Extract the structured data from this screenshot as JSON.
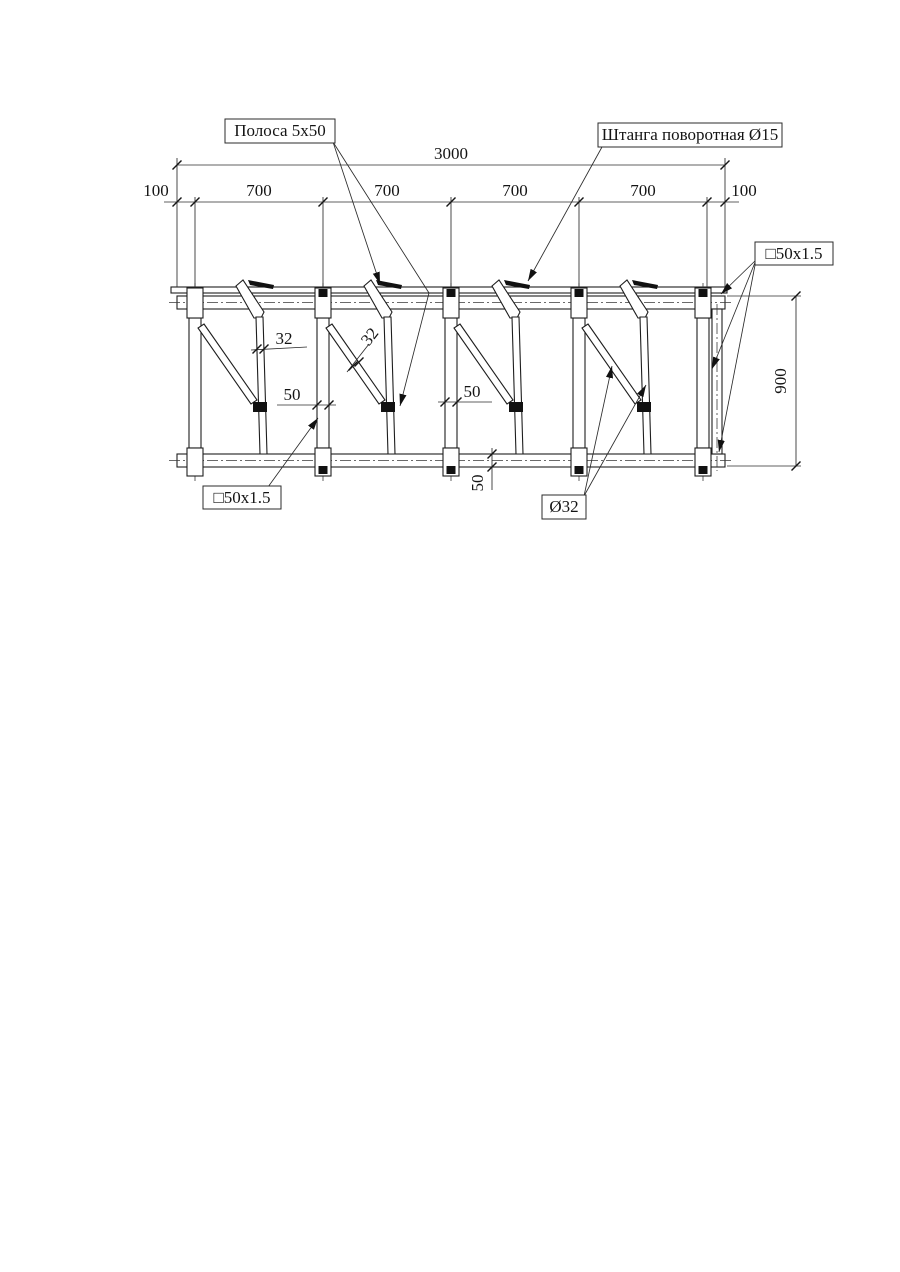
{
  "drawing": {
    "callouts": {
      "strip": "Полоса 5x50",
      "rotating_rod": "Штанга поворотная Ø15",
      "square_tube_right": "□50x1.5",
      "square_tube_left": "□50x1.5",
      "rod_diameter": "Ø32"
    },
    "dims": {
      "total_width": "3000",
      "seg": [
        "100",
        "700",
        "700",
        "700",
        "700",
        "100"
      ],
      "height": "900",
      "rail_depth": "50",
      "rod_width_bay1": "32",
      "brace_width_bay2": "32",
      "post_width_bay1": "50",
      "post_width_bay3": "50"
    }
  }
}
